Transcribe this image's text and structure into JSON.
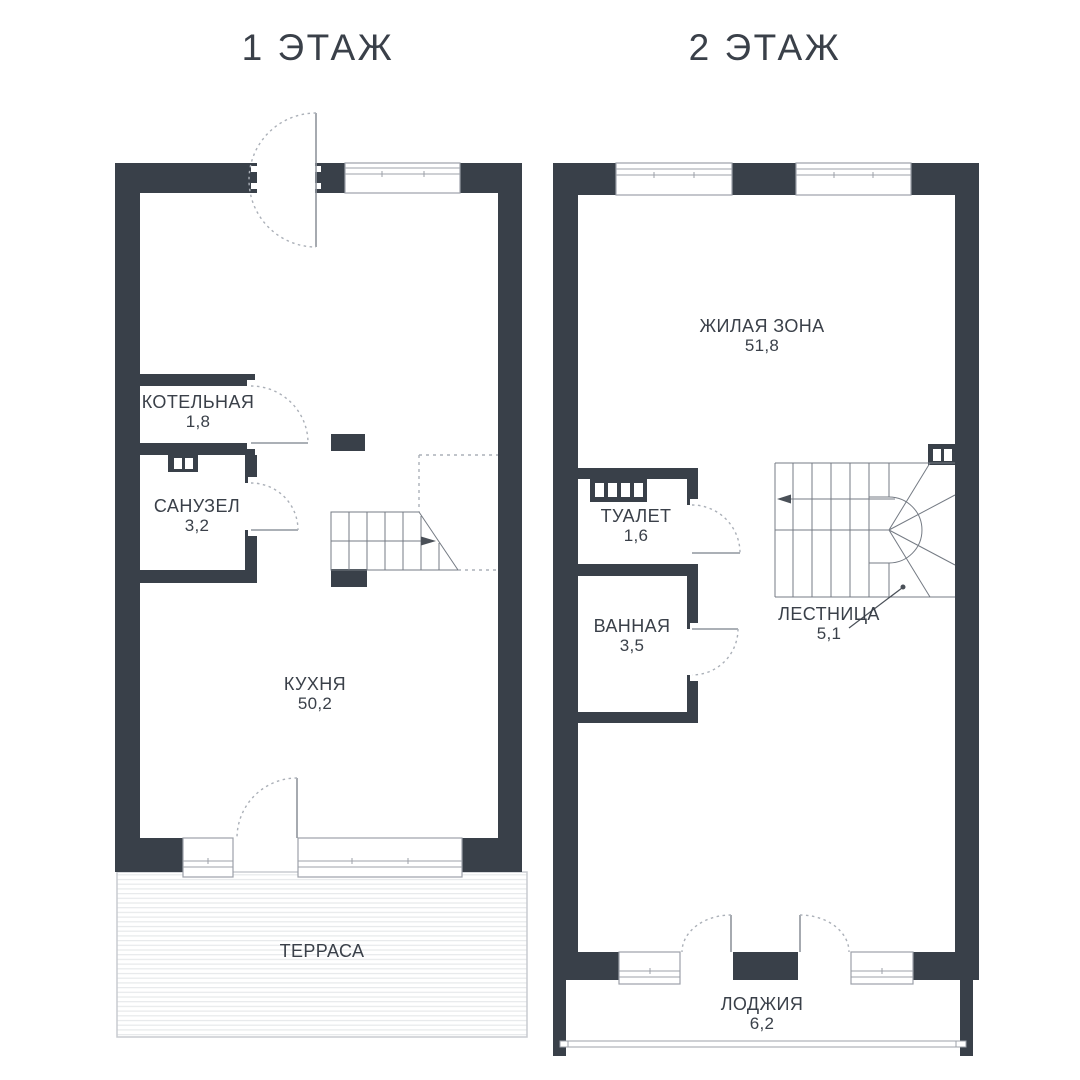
{
  "document": {
    "type": "floor-plan",
    "language": "ru"
  },
  "colors": {
    "wall": "#394049",
    "text": "#3A4049",
    "thin_line": "#9CA1A9",
    "background": "#FFFFFF"
  },
  "floor1": {
    "title": "1 ЭТАЖ",
    "rooms": [
      {
        "name": "КОТЕЛЬНАЯ",
        "area": "1,8"
      },
      {
        "name": "САНУЗЕЛ",
        "area": "3,2"
      },
      {
        "name": "КУХНЯ",
        "area": "50,2"
      },
      {
        "name": "ТЕРРАСА",
        "area": ""
      }
    ],
    "icons": [
      "entrance-door-swing-icon",
      "vent-shaft-icon",
      "stair-up-arrow-icon",
      "window-icon",
      "deck-stripes"
    ]
  },
  "floor2": {
    "title": "2 ЭТАЖ",
    "rooms": [
      {
        "name": "ЖИЛАЯ ЗОНА",
        "area": "51,8"
      },
      {
        "name": "ТУАЛЕТ",
        "area": "1,6"
      },
      {
        "name": "ВАННАЯ",
        "area": "3,5"
      },
      {
        "name": "ЛЕСТНИЦА",
        "area": "5,1"
      },
      {
        "name": "ЛОДЖИЯ",
        "area": "6,2"
      }
    ],
    "icons": [
      "radiator-icon",
      "vent-shaft-icon",
      "stair-down-arrow-icon",
      "winder-stair-icon",
      "window-icon",
      "balcony-railing"
    ]
  }
}
